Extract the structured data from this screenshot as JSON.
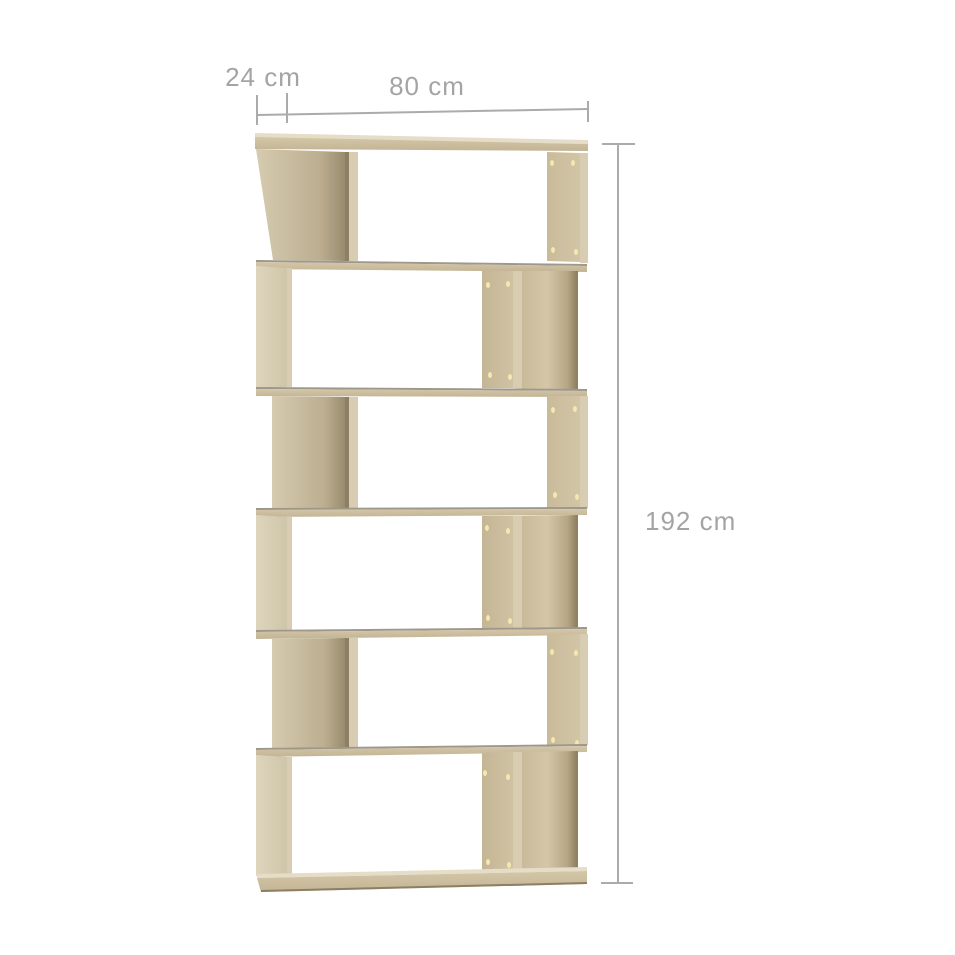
{
  "dimension_labels": {
    "depth": "24 cm",
    "width": "80 cm",
    "height": "192 cm"
  },
  "colors": {
    "background": "#ffffff",
    "wood_light": "#dcd3ba",
    "wood_mid": "#c2b494",
    "wood_inner_light": "#d6cbb0",
    "wood_inner_dark": "#998b6e",
    "wood_edge_light": "#d8cdb3",
    "wood_dark_line": "#8d7f63",
    "wood_top_sheen": "#e6ddc8",
    "board_top_line": "#9e978b",
    "screw_hole": "#f4e7b1",
    "dimension_line": "#ababab",
    "dimension_text": "#a4a4a4"
  }
}
